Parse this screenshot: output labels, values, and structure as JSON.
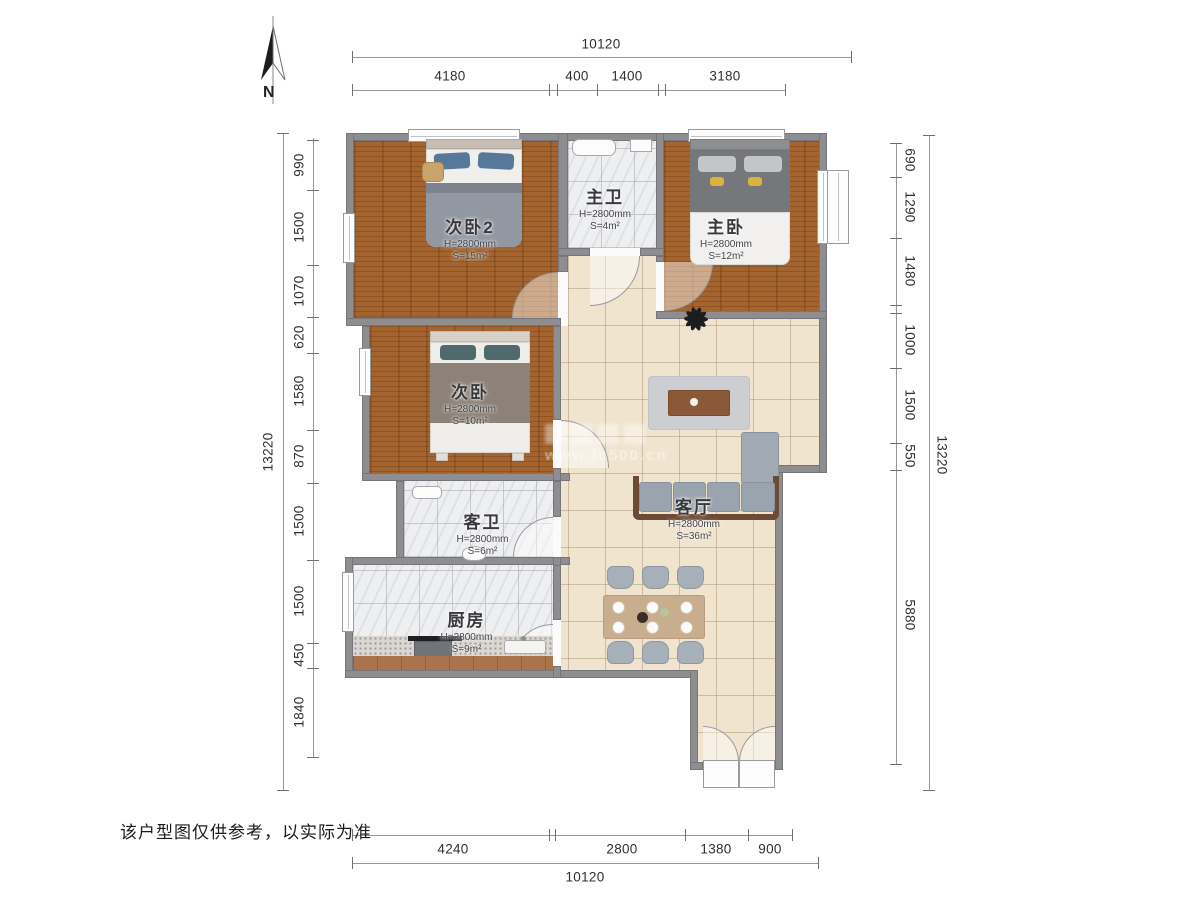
{
  "north": {
    "label": "N"
  },
  "disclaimer": "该户型图仅供参考，以实际为准",
  "watermark": {
    "url": "www.fc500.cn"
  },
  "dims": {
    "top": {
      "overall": "10120",
      "segments": [
        "4180",
        "400",
        "1400",
        "3180"
      ]
    },
    "bottom": {
      "overall": "10120",
      "segments": [
        "4240",
        "2800",
        "1380",
        "900"
      ]
    },
    "left": {
      "overall": "13220",
      "segments": [
        "990",
        "1500",
        "1070",
        "620",
        "1580",
        "870",
        "1500",
        "1500",
        "450",
        "1840"
      ]
    },
    "right": {
      "overall": "13220",
      "segments": [
        "690",
        "1290",
        "1480",
        "1000",
        "1500",
        "550",
        "5880"
      ]
    }
  },
  "rooms": {
    "bedroom2": {
      "name": "次卧2",
      "height": "H=2800mm",
      "area": "S=15m²"
    },
    "master_bath": {
      "name": "主卫",
      "height": "H=2800mm",
      "area": "S=4m²"
    },
    "master_bedroom": {
      "name": "主卧",
      "height": "H=2800mm",
      "area": "S=12m²"
    },
    "bedroom": {
      "name": "次卧",
      "height": "H=2800mm",
      "area": "S=10m²"
    },
    "guest_bath": {
      "name": "客卫",
      "height": "H=2800mm",
      "area": "S=6m²"
    },
    "kitchen": {
      "name": "厨房",
      "height": "H=2800mm",
      "area": "S=9m²"
    },
    "living": {
      "name": "客厅",
      "height": "H=2800mm",
      "area": "S=36m²"
    }
  },
  "colors": {
    "wood": "#a4642f",
    "tile": "#f0e4cf",
    "marble": "#eeeff1",
    "wall": "#8e8e91"
  }
}
